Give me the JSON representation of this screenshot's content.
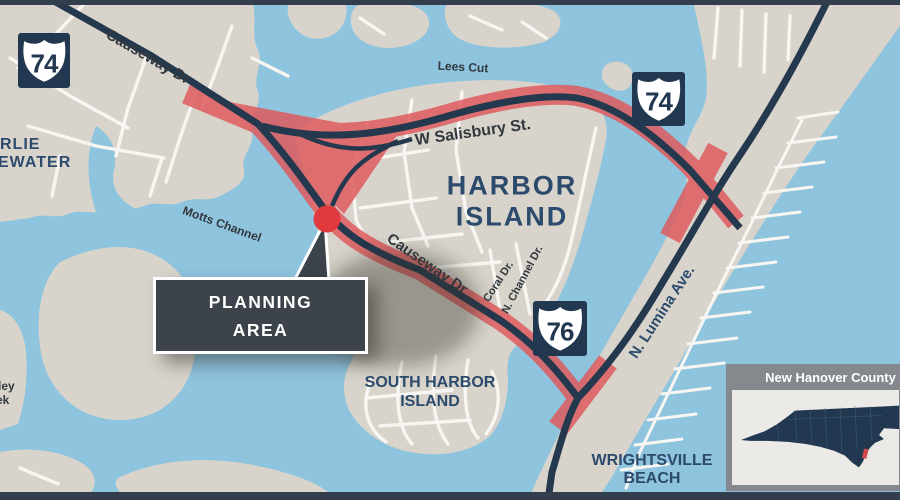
{
  "map": {
    "labels": {
      "causeway_dr_top": "Causeway Dr",
      "lees_cut": "Lees Cut",
      "w_salisbury": "W Salisbury St.",
      "harbor_island_1": "HARBOR",
      "harbor_island_2": "ISLAND",
      "motts_channel": "Motts Channel",
      "causeway_dr_mid": "Causeway Dr",
      "coral_dr": "Coral Dr.",
      "n_channel_dr": "N. Channel Dr.",
      "n_lumina": "N. Lumina Ave.",
      "south_harbor_1": "SOUTH HARBOR",
      "south_harbor_2": "ISLAND",
      "wrightsville_1": "WRIGHTSVILLE",
      "wrightsville_2": "BEACH",
      "edge_left_1": "RLIE",
      "edge_left_2": "EWATER",
      "edge_left_3": "ley",
      "edge_left_4": "ek"
    },
    "shields": [
      {
        "route": "74",
        "position": "northwest"
      },
      {
        "route": "74",
        "position": "northeast"
      },
      {
        "route": "76",
        "position": "center"
      }
    ],
    "callout": {
      "line1": "PLANNING",
      "line2": "AREA"
    },
    "inset": {
      "title": "New Hanover County"
    },
    "colors": {
      "water": "#8EC4DE",
      "land": "#D8D4CC",
      "street": "#F7F6F2",
      "road_dark": "#24384E",
      "corridor": "#DF5C5E",
      "marker_red": "#E13A3E",
      "label_navy": "#2C4A6B",
      "label_dark": "#33383E",
      "callout_bg": "#3C434A",
      "shield_bg": "#223750",
      "bar": "#333E4C",
      "inset_frame": "#85898D",
      "inset_panel": "#ECEAE6",
      "state_navy": "#223850",
      "inset_marker": "#D4494B"
    }
  }
}
